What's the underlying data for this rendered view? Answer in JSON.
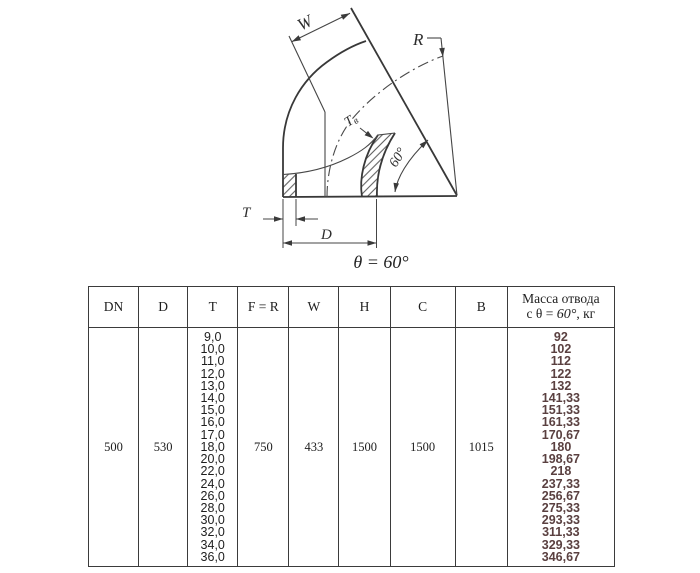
{
  "drawing": {
    "labels": {
      "w": "W",
      "r": "R",
      "tv_main": "Т",
      "tv_sub": "в",
      "angle": "60°",
      "t": "T",
      "d": "D"
    },
    "caption": "θ = 60°",
    "line_color": "#3f3f3f"
  },
  "table": {
    "headers": [
      "DN",
      "D",
      "T",
      "F = R",
      "W",
      "H",
      "C",
      "B"
    ],
    "mass_header": {
      "line1": "Масса отвода",
      "line2_prefix": "с θ = ",
      "line2_value": "60°",
      "line2_suffix": ", кг"
    },
    "row": {
      "dn": "500",
      "d": "530",
      "t_values": [
        "9,0",
        "10,0",
        "11,0",
        "12,0",
        "13,0",
        "14,0",
        "15,0",
        "16,0",
        "17,0",
        "18,0",
        "20,0",
        "22,0",
        "24,0",
        "26,0",
        "28,0",
        "30,0",
        "32,0",
        "34,0",
        "36,0"
      ],
      "f_r": "750",
      "w": "433",
      "h": "1500",
      "c": "1500",
      "b": "1015",
      "mass_values": [
        "92",
        "102",
        "112",
        "122",
        "132",
        "141,33",
        "151,33",
        "161,33",
        "170,67",
        "180",
        "198,67",
        "218",
        "237,33",
        "256,67",
        "275,33",
        "293,33",
        "311,33",
        "329,33",
        "346,67"
      ]
    },
    "mass_color": "#5a4040"
  }
}
